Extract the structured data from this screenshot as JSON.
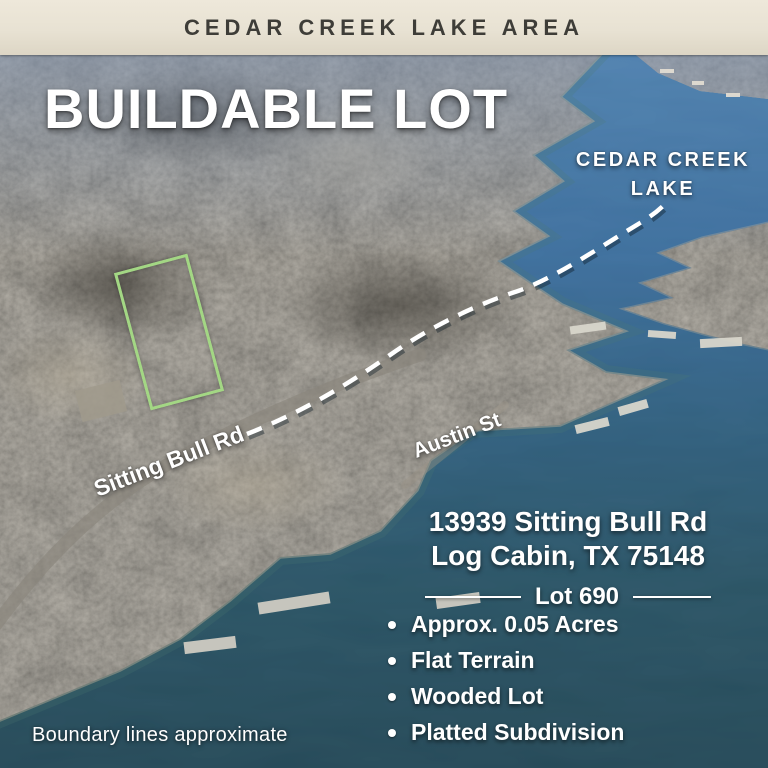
{
  "banner": {
    "label": "CEDAR CREEK LAKE AREA"
  },
  "headline": {
    "title": "BUILDABLE LOT"
  },
  "map_labels": {
    "lake_line1": "CEDAR CREEK",
    "lake_line2": "LAKE",
    "road_sitting_bull": "Sitting Bull Rd",
    "road_austin": "Austin St"
  },
  "listing": {
    "address_line1": "13939 Sitting Bull Rd",
    "address_line2": "Log Cabin, TX 75148",
    "lot_label": "Lot 690",
    "features": [
      "Approx. 0.05 Acres",
      "Flat Terrain",
      "Wooded Lot",
      "Platted Subdivision"
    ]
  },
  "footnote": {
    "text": "Boundary lines approximate"
  },
  "colors": {
    "banner_bg": "#e8e2d3",
    "banner_text": "#3e3d38",
    "overlay_text": "#ffffff",
    "lot_outline_green": "#a3d784",
    "water_top": "#4c7dad",
    "water_bottom": "#1d3f4d",
    "land": "#6b665c",
    "route_dash": "#ffffff"
  }
}
